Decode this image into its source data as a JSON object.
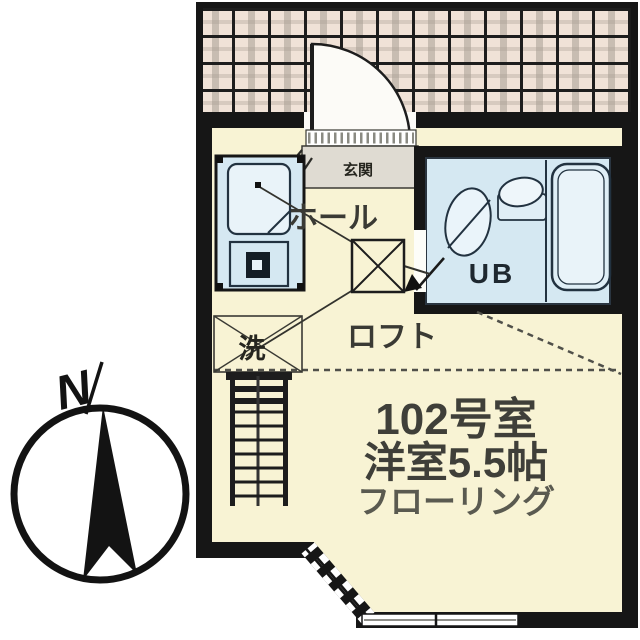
{
  "plan": {
    "labels": {
      "north_indicator": "N",
      "entrance": "玄関",
      "hall": "ホール",
      "unit_bath": "UB",
      "loft": "ロフト",
      "laundry": "洗"
    },
    "room_info": {
      "room_number": "102号室",
      "room_size": "洋室5.5帖",
      "flooring": "フローリング"
    },
    "colors": {
      "floor_cream": "#f8f3d4",
      "corridor_tile": "#f0e2d7",
      "tile_grid_line": "#1d1d1d",
      "fixture_blue": "#d5e8f2",
      "fixture_blue_light": "#e9f3f9",
      "wall_black": "#161616",
      "text_dark": "#3a3a34",
      "step_grey": "#dfdbd2"
    }
  }
}
